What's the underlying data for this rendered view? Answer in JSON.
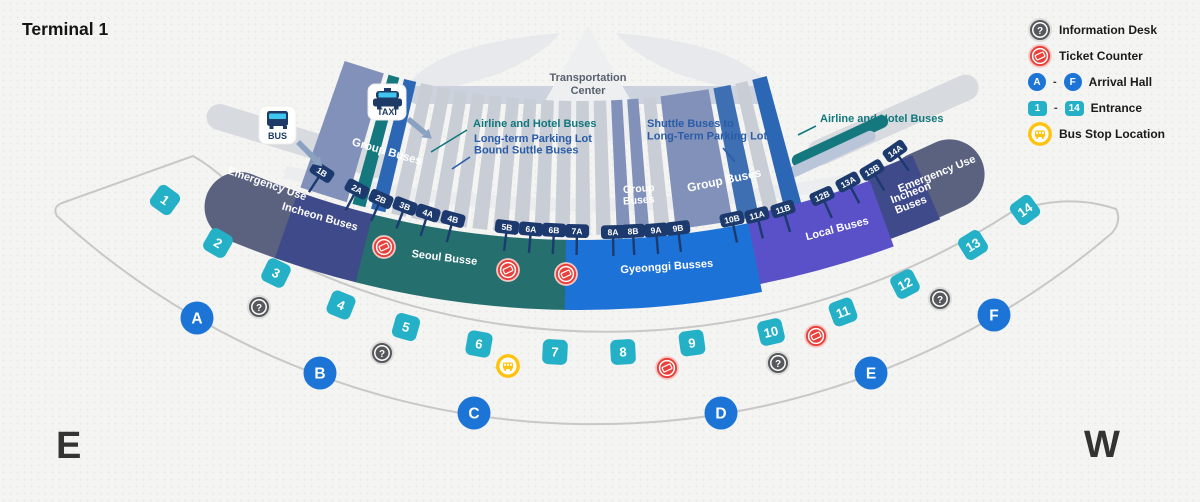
{
  "title": "Terminal 1",
  "compass": {
    "east": "E",
    "west": "W"
  },
  "legend": {
    "information": "Information Desk",
    "ticket": "Ticket Counter",
    "arrival": {
      "from": "A",
      "to": "F",
      "separator": "-",
      "label": "Arrival Hall"
    },
    "entrance": {
      "from": "1",
      "to": "14",
      "separator": "-",
      "label": "Entrance"
    },
    "bus_stop": "Bus Stop Location"
  },
  "colors": {
    "emergency": "#5a6280",
    "incheon": "#3f4a8b",
    "seoul": "#25706f",
    "gyeonggi": "#1d72d8",
    "local": "#5a50c8",
    "group_wedge": "#8191ba",
    "group_wedge_dark": "#3d6fb2",
    "airline_wedge": "#15787e",
    "parking_wedge": "#2c67b5",
    "pale_wedge": "#b9c6da",
    "gray_wedge": "#c9cdd5",
    "ramp": "#d7dade",
    "gate_chip": "#1c3a6e",
    "entrance_chip": "#24b0c6",
    "arrival_hall": "#1b74d6",
    "info_icon": "#55585c",
    "ticket_icon": "#e8413c",
    "bus_stop_icon": "#ffc20d",
    "callout_blue": "#2a5ca8",
    "callout_teal": "#10777c",
    "road": "#c8c8c8",
    "tc_text": "#59616e",
    "icon_navy": "#1d3b66",
    "icon_cyan": "#3fc6f0",
    "arrow": "#8ba1c2"
  },
  "map": {
    "transportation_center": {
      "lines": [
        "Transportation",
        "Center"
      ],
      "x": 588,
      "y": 81
    },
    "transport_modes": [
      {
        "label": "BUS",
        "x": 259,
        "y": 106,
        "w": 37,
        "h": 38,
        "type": "bus"
      },
      {
        "label": "TAXI",
        "x": 368,
        "y": 84,
        "w": 38,
        "h": 36,
        "type": "taxi"
      }
    ],
    "arrows": [
      [
        298,
        142,
        316,
        160
      ],
      [
        408,
        119,
        425,
        133
      ]
    ],
    "callouts": [
      {
        "lines": [
          "Airline and Hotel Buses"
        ],
        "color": "callout_teal",
        "x": 473,
        "y": 127,
        "lh": 12,
        "leader": [
          467,
          130,
          431,
          152
        ]
      },
      {
        "lines": [
          "Long-term Parking Lot",
          "Bound Suttle Buses"
        ],
        "color": "callout_blue",
        "x": 474,
        "y": 142,
        "lh": 11.5,
        "leader": [
          470,
          157,
          452,
          169
        ]
      },
      {
        "lines": [
          "Shuttle Buses to",
          "Long-Term Parking Lot"
        ],
        "color": "callout_blue",
        "x": 647,
        "y": 127,
        "lh": 12.5,
        "leader": [
          723,
          148,
          735,
          162
        ]
      },
      {
        "lines": [
          "Airline and Hotel Buses"
        ],
        "color": "callout_teal",
        "x": 820,
        "y": 122,
        "lh": 12,
        "leader": [
          816,
          126,
          798,
          135
        ]
      }
    ],
    "group_labels": [
      {
        "lines": [
          "Group Buses"
        ],
        "x": 386,
        "y": 155,
        "rot": 16,
        "size": 11.5,
        "lh": 12
      },
      {
        "lines": [
          "Group",
          "Buses"
        ],
        "x": 639,
        "y": 192,
        "rot": -4,
        "size": 10.5,
        "lh": 11.5
      },
      {
        "lines": [
          "Group Buses"
        ],
        "x": 725,
        "y": 184,
        "rot": -12,
        "size": 12,
        "lh": 12
      }
    ],
    "zones": [
      {
        "id": "emergency-left",
        "label": "Emergency Use",
        "color": "emergency",
        "a0": -22.6,
        "a1": -19.2,
        "rmid": 886,
        "cap": "round",
        "lx": 266,
        "ly": 187,
        "rot": 19
      },
      {
        "id": "emergency-right",
        "label": "Emergency Use",
        "color": "emergency",
        "a0": 23.3,
        "a1": 25.2,
        "rmid": 868,
        "cap": "round",
        "lx": 938,
        "ly": 177,
        "rot": -22
      },
      {
        "id": "incheon-left",
        "label": "Incheon Buses",
        "color": "incheon",
        "a0": -19.35,
        "a1": -14.0,
        "rmid": 886,
        "lx": 319,
        "ly": 220,
        "rot": 16
      },
      {
        "id": "incheon-right",
        "label": "Incheon|Buses",
        "color": "incheon",
        "a0": 20.0,
        "a1": 23.45,
        "rmid": 870,
        "lx": 912,
        "ly": 196,
        "rot": -21,
        "lh": 12
      },
      {
        "id": "seoul",
        "label": "Seoul Busse",
        "color": "seoul",
        "a0": -14.1,
        "a1": -0.85,
        "rmid": 886,
        "lx": 444,
        "ly": 261,
        "rot": 7
      },
      {
        "id": "local",
        "label": "Local Buses",
        "color": "local",
        "a0": 11.3,
        "a1": 20.1,
        "rmid": 878,
        "lx": 838,
        "ly": 232,
        "rot": -15
      },
      {
        "id": "gyeonggi",
        "label": "Gyeonggi Busses",
        "color": "gyeonggi",
        "a0": -0.95,
        "a1": 11.4,
        "rmid": 886,
        "lx": 667,
        "ly": 270,
        "rot": -4
      }
    ],
    "gates": [
      {
        "label": "1B",
        "x": 322,
        "y": 172,
        "rot": 33
      },
      {
        "label": "2A",
        "x": 357,
        "y": 189,
        "rot": 28
      },
      {
        "label": "2B",
        "x": 381,
        "y": 199,
        "rot": 24
      },
      {
        "label": "3B",
        "x": 405,
        "y": 206,
        "rot": 21
      },
      {
        "label": "4A",
        "x": 428,
        "y": 213,
        "rot": 18
      },
      {
        "label": "4B",
        "x": 453,
        "y": 219,
        "rot": 15
      },
      {
        "label": "5B",
        "x": 507,
        "y": 227,
        "rot": 7
      },
      {
        "label": "6A",
        "x": 531,
        "y": 229,
        "rot": 5
      },
      {
        "label": "6B",
        "x": 554,
        "y": 230,
        "rot": 3
      },
      {
        "label": "7A",
        "x": 577,
        "y": 231,
        "rot": 1
      },
      {
        "label": "8A",
        "x": 613,
        "y": 232,
        "rot": -1
      },
      {
        "label": "8B",
        "x": 633,
        "y": 231,
        "rot": -3
      },
      {
        "label": "9A",
        "x": 656,
        "y": 230,
        "rot": -5
      },
      {
        "label": "9B",
        "x": 678,
        "y": 228,
        "rot": -7
      },
      {
        "label": "10B",
        "x": 732,
        "y": 219,
        "rot": -12
      },
      {
        "label": "11A",
        "x": 757,
        "y": 215,
        "rot": -14
      },
      {
        "label": "11B",
        "x": 783,
        "y": 209,
        "rot": -17
      },
      {
        "label": "12B",
        "x": 822,
        "y": 196,
        "rot": -24
      },
      {
        "label": "13A",
        "x": 848,
        "y": 182,
        "rot": -28
      },
      {
        "label": "13B",
        "x": 872,
        "y": 170,
        "rot": -31
      },
      {
        "label": "14A",
        "x": 895,
        "y": 151,
        "rot": -35
      }
    ],
    "entrances": [
      {
        "label": "1",
        "x": 165,
        "y": 200,
        "rot": 36
      },
      {
        "label": "2",
        "x": 218,
        "y": 243,
        "rot": 30
      },
      {
        "label": "3",
        "x": 276,
        "y": 273,
        "rot": 26
      },
      {
        "label": "4",
        "x": 341,
        "y": 305,
        "rot": 22
      },
      {
        "label": "5",
        "x": 406,
        "y": 327,
        "rot": 16
      },
      {
        "label": "6",
        "x": 479,
        "y": 344,
        "rot": 10
      },
      {
        "label": "7",
        "x": 555,
        "y": 352,
        "rot": 3
      },
      {
        "label": "8",
        "x": 623,
        "y": 352,
        "rot": -3
      },
      {
        "label": "9",
        "x": 692,
        "y": 343,
        "rot": -8
      },
      {
        "label": "10",
        "x": 771,
        "y": 332,
        "rot": -13
      },
      {
        "label": "11",
        "x": 843,
        "y": 312,
        "rot": -20
      },
      {
        "label": "12",
        "x": 905,
        "y": 284,
        "rot": -27
      },
      {
        "label": "13",
        "x": 973,
        "y": 245,
        "rot": -32
      },
      {
        "label": "14",
        "x": 1025,
        "y": 210,
        "rot": -36
      }
    ],
    "arrival_halls": [
      {
        "label": "A",
        "x": 197,
        "y": 318
      },
      {
        "label": "B",
        "x": 320,
        "y": 373
      },
      {
        "label": "C",
        "x": 474,
        "y": 413
      },
      {
        "label": "D",
        "x": 721,
        "y": 413
      },
      {
        "label": "E",
        "x": 871,
        "y": 373
      },
      {
        "label": "F",
        "x": 994,
        "y": 315
      }
    ],
    "facilities": {
      "information": [
        [
          259,
          307
        ],
        [
          382,
          353
        ],
        [
          778,
          363
        ],
        [
          940,
          299
        ]
      ],
      "ticket": [
        [
          384,
          247
        ],
        [
          508,
          270
        ],
        [
          566,
          274
        ],
        [
          667,
          368
        ],
        [
          816,
          336
        ]
      ],
      "bus_stop": [
        [
          508,
          366
        ]
      ]
    }
  }
}
